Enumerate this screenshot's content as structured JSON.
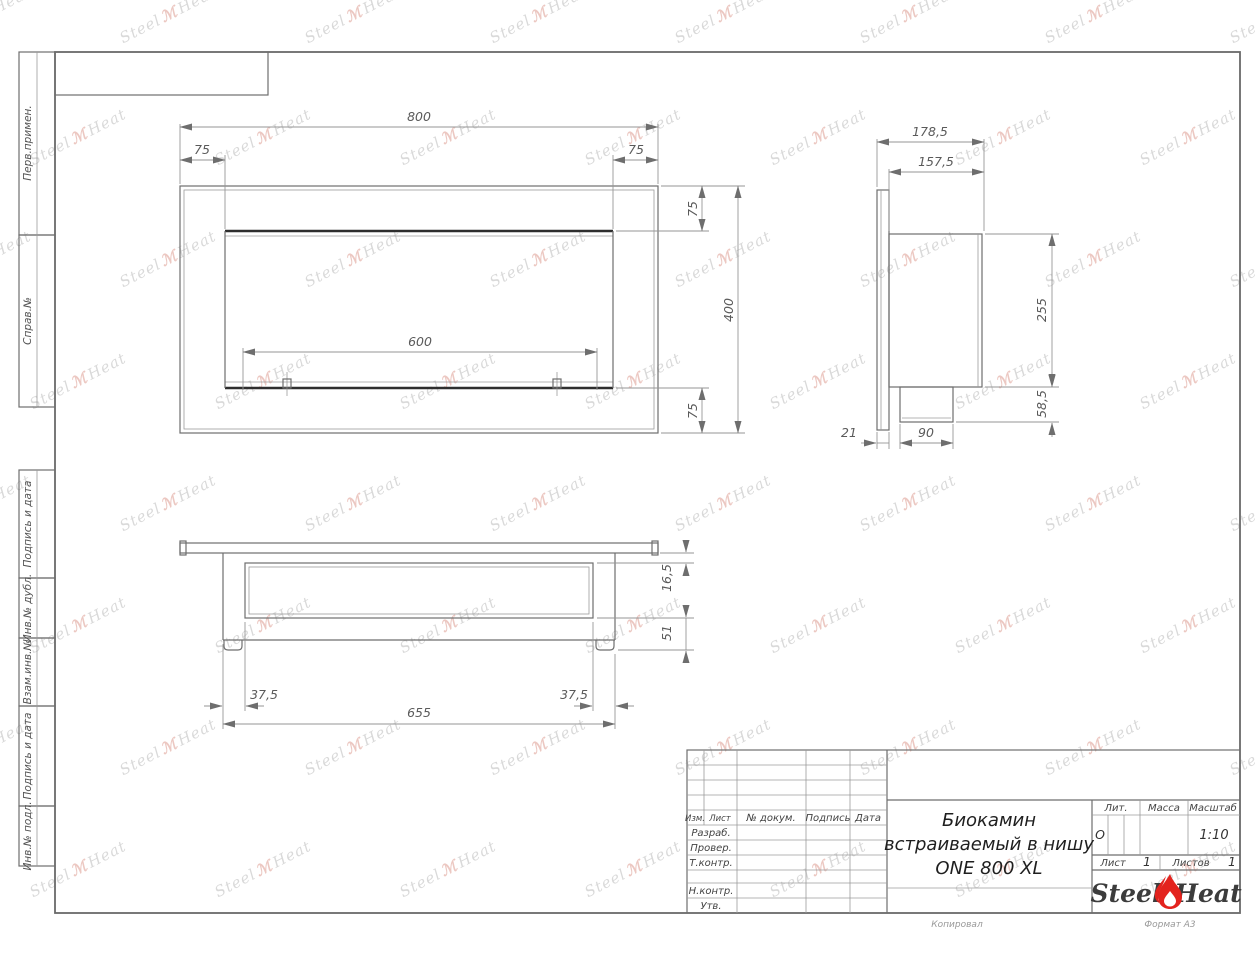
{
  "watermark": {
    "text_left": "Steel",
    "mark": "ℳ",
    "text_right": "Heat"
  },
  "margin_labels": [
    "Перв.примен.",
    "Справ.№",
    "Подпись и дата",
    "Инв.№ дубл.",
    "Взам.инв.№",
    "Подпись и дата",
    "Инв.№ подл."
  ],
  "front_view": {
    "width": "800",
    "left_inset": "75",
    "right_inset": "75",
    "opening_width": "600",
    "top_inset": "75",
    "height": "400",
    "bottom_inset": "75"
  },
  "side_view": {
    "total_depth": "178,5",
    "body_depth": "157,5",
    "body_height": "255",
    "tray_height": "58,5",
    "flange_thickness": "21",
    "tray_depth": "90"
  },
  "bottom_view": {
    "flange_gap": "16,5",
    "tray_drop": "51",
    "left_inset": "37,5",
    "right_inset": "37,5",
    "body_width": "655"
  },
  "title_block": {
    "cols": {
      "izm": "Изм.",
      "list": "Лист",
      "doc": "№ докум.",
      "podpis": "Подпись",
      "data": "Дата"
    },
    "rows": {
      "razrab": "Разраб.",
      "prover": "Провер.",
      "tkontr": "Т.контр.",
      "nkontr": "Н.контр.",
      "utv": "Утв."
    },
    "title": {
      "line1": "Биокамин",
      "line2": "встраиваемый в нишу",
      "line3": "ONE 800 XL"
    },
    "lit": {
      "label": "Лит.",
      "value": "О"
    },
    "massa": {
      "label": "Масса"
    },
    "scale": {
      "label": "Масштаб",
      "value": "1:10"
    },
    "sheet": {
      "label": "Лист",
      "value": "1"
    },
    "sheets": {
      "label": "Листов",
      "value": "1"
    },
    "logo": {
      "left": "Steel",
      "right": "Heat"
    },
    "footer": {
      "copied": "Копировал",
      "format": "Формат А3"
    }
  }
}
